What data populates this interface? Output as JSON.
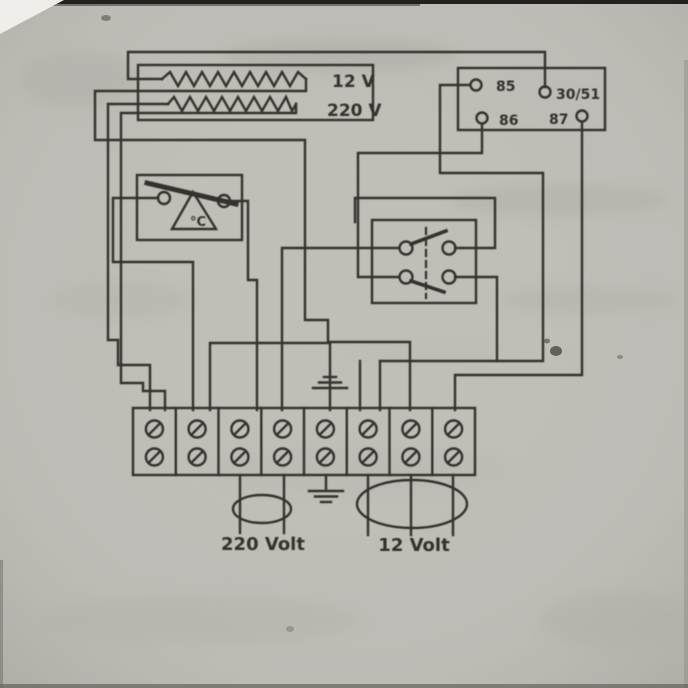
{
  "page": {
    "paper_hex": "#c9c7c0",
    "ink_hex": "#33322d"
  },
  "heater": {
    "label_12v": "12 V",
    "label_220v": "220 V"
  },
  "relay": {
    "terminals": [
      {
        "id": "85"
      },
      {
        "id": "30/51"
      },
      {
        "id": "86"
      },
      {
        "id": "87"
      }
    ]
  },
  "thermostat": {
    "label": "°C"
  },
  "terminal_strip": {
    "terminal_count": "8"
  },
  "cables": [
    {
      "label": "220 Volt"
    },
    {
      "label": "12 Volt"
    }
  ]
}
